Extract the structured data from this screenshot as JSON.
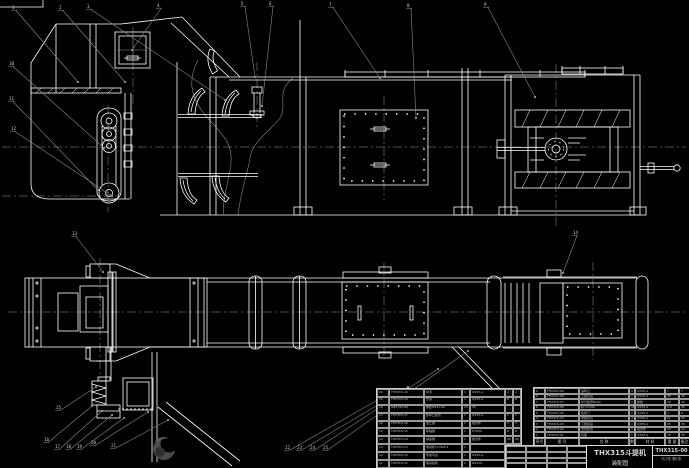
{
  "drawing": {
    "type": "cad-assembly-drawing",
    "colors": {
      "background": "#000000",
      "line": "#ffffff",
      "leader": "#8a8a8a",
      "centerline": "#9a9a9a",
      "bom_text": "#c0c0c0",
      "watermark": "#4a4a4a"
    },
    "title_block": {
      "product": "THX315斗提机",
      "sheet_name": "装配图",
      "drawing_no": "THX315-00",
      "sheet_info": "共1张 第1张"
    },
    "bom_header_cells": [
      "序号",
      "图 号",
      "名 称",
      "数",
      "材 料",
      "重 量",
      "备注"
    ],
    "bom_left_rows": [
      [
        "20",
        "THX315-20",
        "护罩",
        "1",
        "Q235-A",
        "4",
        "4"
      ],
      [
        "19",
        "THX315-19",
        "支架",
        "1",
        "Q235-A",
        "6",
        "6"
      ],
      [
        "18",
        "GB5782-86",
        "螺栓M12×40",
        "24",
        "35",
        "",
        ""
      ],
      [
        "17",
        "THX315-17",
        "卸料口接管",
        "1",
        "Q235-A",
        "5",
        "5"
      ],
      [
        "16",
        "THX315-16",
        "逆止器",
        "1",
        "组合件",
        "3",
        "3"
      ],
      [
        "15",
        "THX315-15",
        "联轴器",
        "1",
        "HT200",
        "8",
        "8"
      ],
      [
        "14",
        "THX315-14",
        "减速器",
        "1",
        "组合件",
        "45",
        "45"
      ],
      [
        "13",
        "THX315-13",
        "电动机Y132M-4",
        "1",
        "",
        "49",
        "49"
      ],
      [
        "12",
        "THX315-12",
        "传动平台",
        "1",
        "Q235-A",
        "22",
        "22"
      ],
      [
        "11",
        "THX315-11",
        "驱动链轮",
        "2",
        "ZG310",
        "16",
        "32"
      ]
    ],
    "bom_right_rows": [
      [
        "9",
        "THX315-09",
        "进料口",
        "1",
        "Q235-A",
        "7",
        "7"
      ],
      [
        "8",
        "THX315-08",
        "上部区段",
        "1",
        "Q235-A",
        "38",
        "38"
      ],
      [
        "7",
        "THX315-07",
        "牵引胶带B400",
        "1",
        "橡胶",
        "26",
        "26"
      ],
      [
        "6",
        "THX315-06",
        "料斗Q160",
        "38",
        "Q235-A",
        "0.8",
        "30"
      ],
      [
        "5",
        "THX315-05",
        "检视门",
        "2",
        "Q235-A",
        "3",
        "6"
      ],
      [
        "4",
        "THX315-04",
        "中部机壳",
        "4",
        "Q235-A",
        "21",
        "84"
      ],
      [
        "3",
        "THX315-03",
        "下部区段",
        "1",
        "Q235-A",
        "35",
        "35"
      ],
      [
        "2",
        "THX315-02",
        "张紧装置",
        "1",
        "组合件",
        "12",
        "12"
      ],
      [
        "1",
        "THX315-01",
        "机座",
        "1",
        "Q235-A",
        "35",
        "35"
      ]
    ],
    "revision_grid": {
      "rows": 4,
      "cols": 4
    },
    "balloons": [
      {
        "n": "1",
        "x": 12,
        "y": 9,
        "tx": 78,
        "ty": 82
      },
      {
        "n": "2",
        "x": 59,
        "y": 9,
        "tx": 125,
        "ty": 82
      },
      {
        "n": "3",
        "x": 87,
        "y": 8,
        "tx": 225,
        "ty": 100
      },
      {
        "n": "4",
        "x": 157,
        "y": 7,
        "tx": 132,
        "ty": 50
      },
      {
        "n": "5",
        "x": 241,
        "y": 5,
        "tx": 255,
        "ty": 77
      },
      {
        "n": "6",
        "x": 269,
        "y": 5,
        "tx": 262,
        "ty": 106
      },
      {
        "n": "7",
        "x": 329,
        "y": 6,
        "tx": 380,
        "ty": 78
      },
      {
        "n": "8",
        "x": 407,
        "y": 7,
        "tx": 416,
        "ty": 118
      },
      {
        "n": "9",
        "x": 484,
        "y": 6,
        "tx": 535,
        "ty": 97
      },
      {
        "n": "10",
        "x": 9,
        "y": 65,
        "tx": 104,
        "ty": 148
      },
      {
        "n": "11",
        "x": 9,
        "y": 100,
        "tx": 98,
        "ty": 190
      },
      {
        "n": "12",
        "x": 11,
        "y": 130,
        "tx": 112,
        "ty": 196
      },
      {
        "n": "13",
        "x": 72,
        "y": 235,
        "tx": 103,
        "ty": 272
      },
      {
        "n": "14",
        "x": 573,
        "y": 234,
        "tx": 563,
        "ty": 273
      },
      {
        "n": "15",
        "x": 56,
        "y": 409,
        "tx": 96,
        "ty": 387
      },
      {
        "n": "16",
        "x": 44,
        "y": 441,
        "tx": 92,
        "ty": 406
      },
      {
        "n": "17",
        "x": 55,
        "y": 448,
        "tx": 102,
        "ty": 411
      },
      {
        "n": "18",
        "x": 66,
        "y": 448,
        "tx": 112,
        "ty": 415
      },
      {
        "n": "19",
        "x": 77,
        "y": 448,
        "tx": 124,
        "ty": 418
      },
      {
        "n": "20",
        "x": 91,
        "y": 444,
        "tx": 148,
        "ty": 412
      },
      {
        "n": "21",
        "x": 111,
        "y": 447,
        "tx": 168,
        "ty": 420
      },
      {
        "n": "22",
        "x": 285,
        "y": 449,
        "tx": 388,
        "ty": 394
      },
      {
        "n": "23",
        "x": 297,
        "y": 449,
        "tx": 408,
        "ty": 387
      },
      {
        "n": "24",
        "x": 310,
        "y": 449,
        "tx": 438,
        "ty": 369
      },
      {
        "n": "25",
        "x": 323,
        "y": 449,
        "tx": 468,
        "ty": 351
      }
    ]
  }
}
